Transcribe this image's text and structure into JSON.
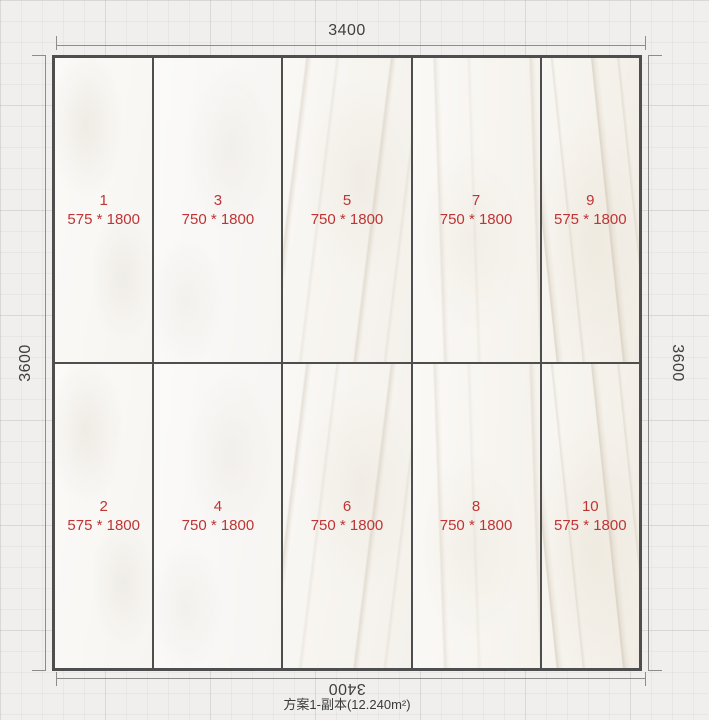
{
  "panel": {
    "dimensions": {
      "top": "3400",
      "bottom": "3400",
      "left": "3600",
      "right": "3600"
    },
    "plan_label": "方案1-副本(12.240m²)"
  },
  "tiles": [
    {
      "id": "1",
      "size": "575 * 1800"
    },
    {
      "id": "2",
      "size": "575 * 1800"
    },
    {
      "id": "3",
      "size": "750 * 1800"
    },
    {
      "id": "4",
      "size": "750 * 1800"
    },
    {
      "id": "5",
      "size": "750 * 1800"
    },
    {
      "id": "6",
      "size": "750 * 1800"
    },
    {
      "id": "7",
      "size": "750 * 1800"
    },
    {
      "id": "8",
      "size": "750 * 1800"
    },
    {
      "id": "9",
      "size": "575 * 1800"
    },
    {
      "id": "10",
      "size": "575 * 1800"
    }
  ],
  "colors": {
    "tile_label_red": "#bf3434",
    "dimension_text": "#3f3f3f",
    "panel_border": "#4e4e4e",
    "background": "#f0efee"
  }
}
